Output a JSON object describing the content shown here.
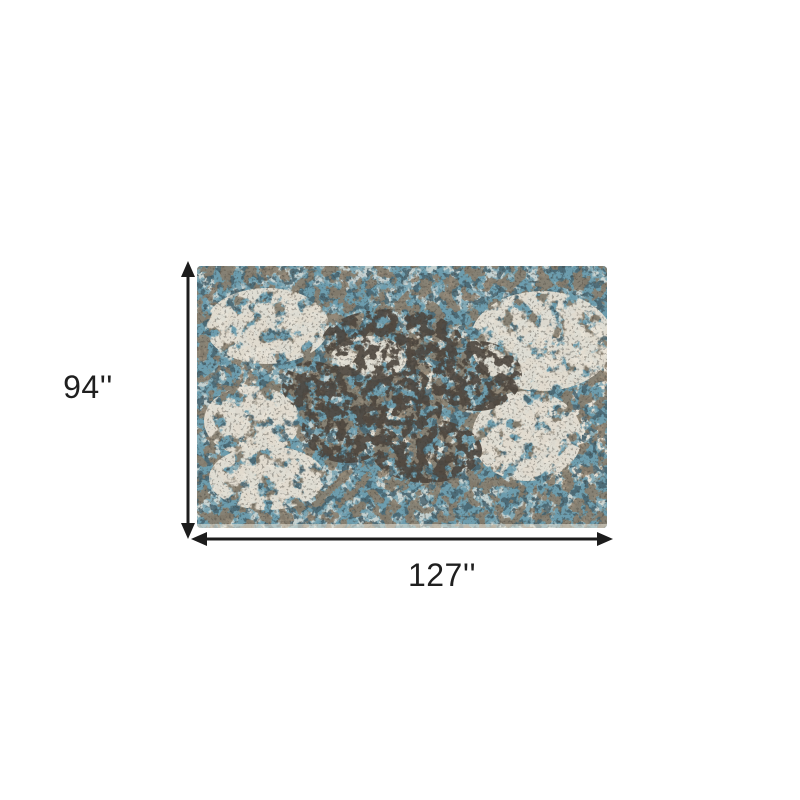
{
  "diagram": {
    "type": "product-dimension-diagram",
    "subject": "Abstract distressed area rug in blue, gray, taupe and ivory",
    "height_label": "94''",
    "width_label": "127''"
  },
  "theme": {
    "background": "#ffffff",
    "arrow": "#1c1c1c",
    "text": "#1f1f1f",
    "rug-cream": "#e9e3d7",
    "rug-light-blue": "#a9c4cc",
    "rug-blue": "#6d9dae",
    "rug-navy": "#445f6b",
    "rug-taupe": "#8b7d6b",
    "rug-dark": "#4d453c",
    "rug-grain": "#3c3a36"
  }
}
